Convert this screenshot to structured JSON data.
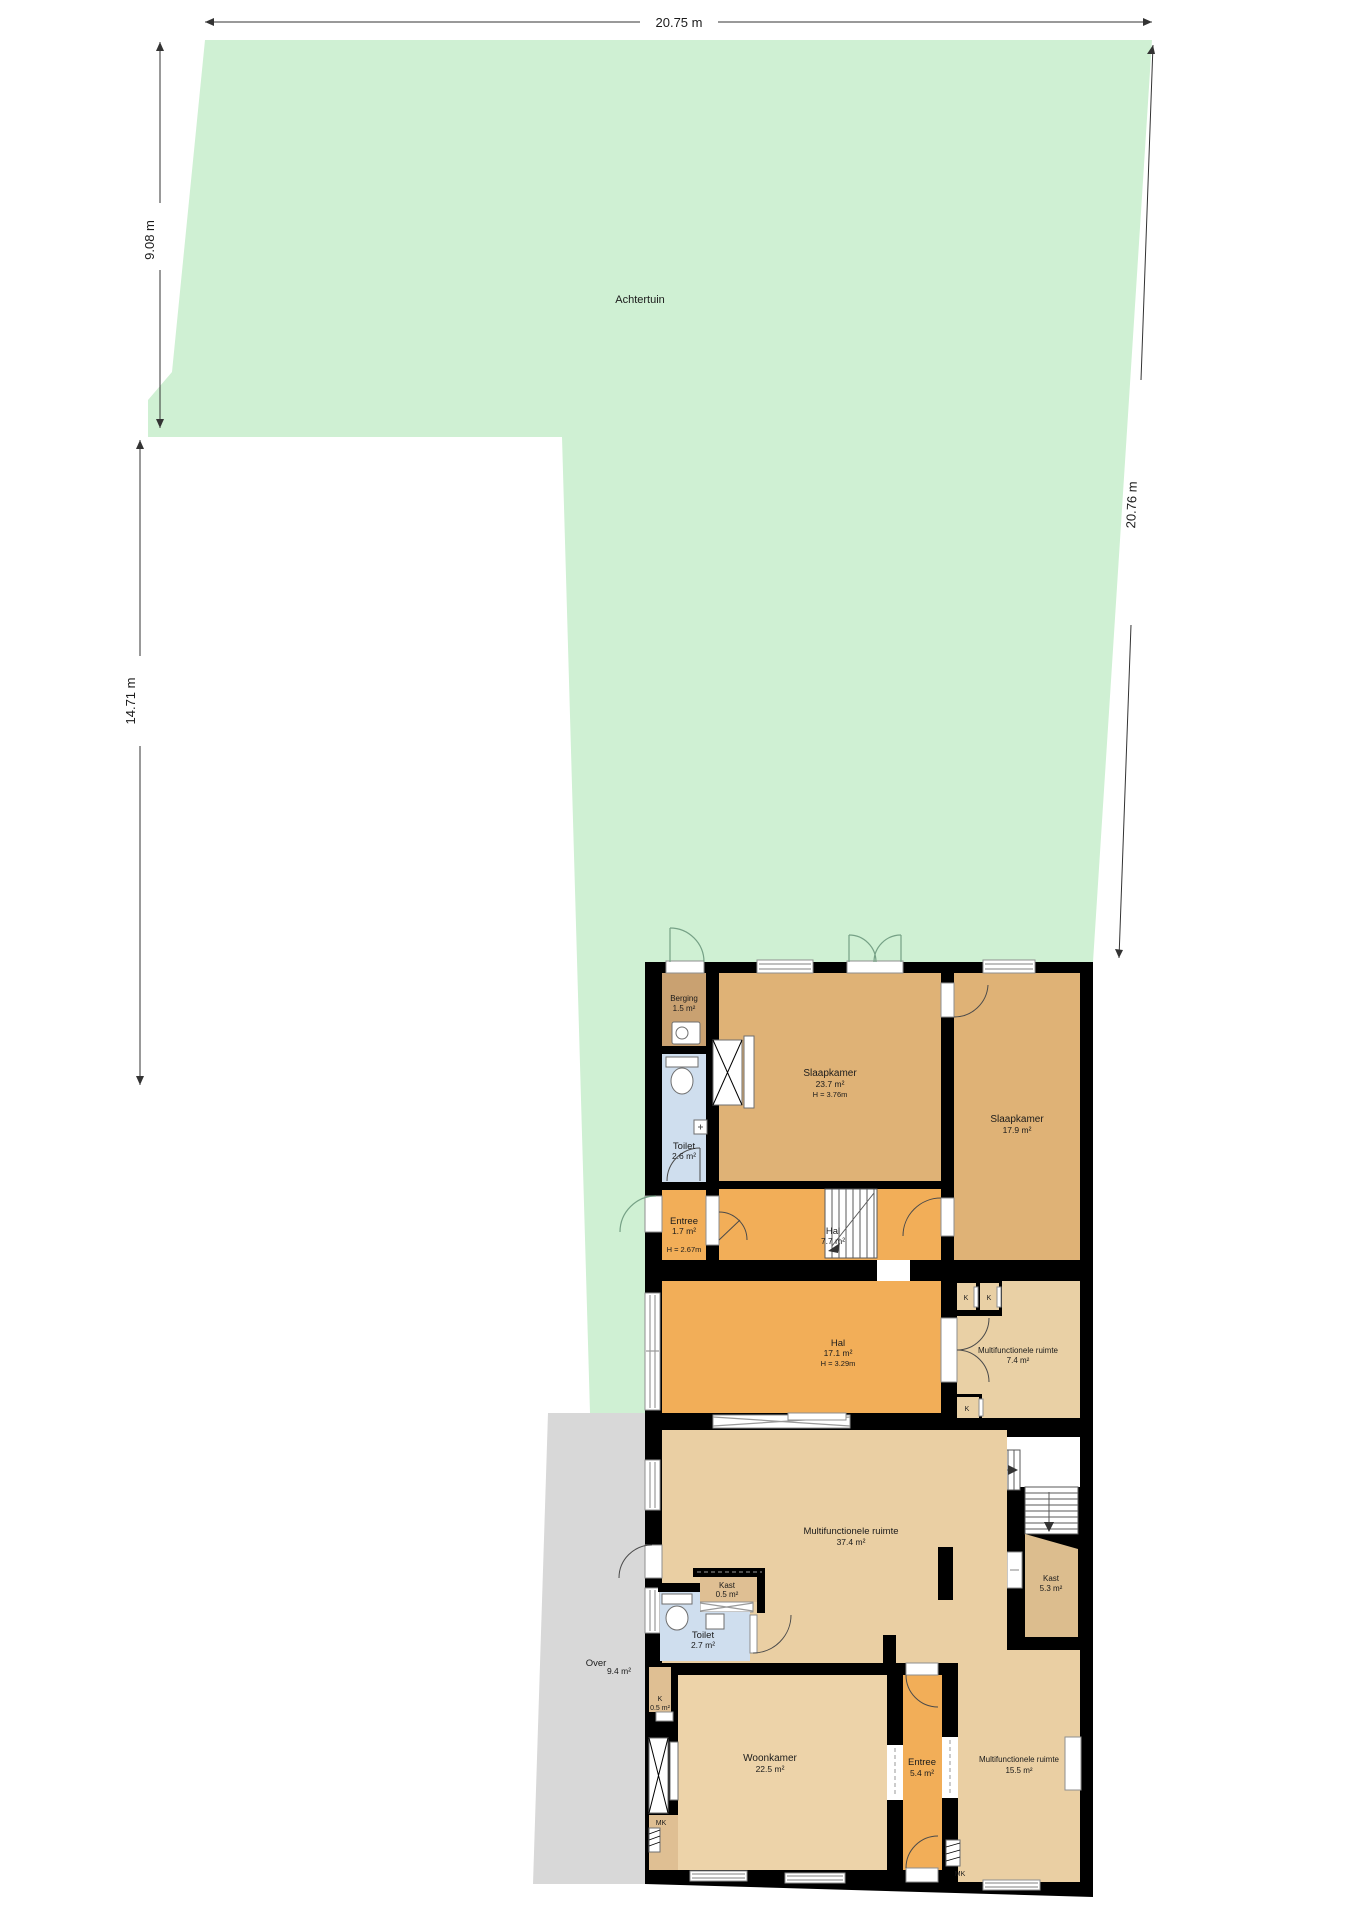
{
  "palette": {
    "garden_green": "#cff0d3",
    "paving_gray": "#d8d8d8",
    "bedroom_tan": "#dfb276",
    "storage_brown": "#c9a171",
    "hall_orange": "#f2ae58",
    "living_beige": "#eacfa3",
    "closet_tan": "#dfbf93",
    "kast_dark_tan": "#dcbd8e",
    "toilet_blue": "#cfdeee",
    "wall_black": "#000000"
  },
  "garden": {
    "label": "Achtertuin"
  },
  "over_area": {
    "label": "Over",
    "area": "9.4 m²"
  },
  "dimensions": {
    "top": "20.75 m",
    "left_upper": "9.08 m",
    "left_lower": "14.71 m",
    "right": "20.76 m"
  },
  "rooms": {
    "berging": {
      "name": "Berging",
      "area": "1.5 m²"
    },
    "toilet_boven": {
      "name": "Toilet",
      "area": "2.6 m²"
    },
    "slaapkamer_groot": {
      "name": "Slaapkamer",
      "area": "23.7 m²",
      "height": "H = 3.76m"
    },
    "slaapkamer_klein": {
      "name": "Slaapkamer",
      "area": "17.9 m²"
    },
    "entree_boven": {
      "name": "Entree",
      "area": "1.7 m²",
      "height": "H = 2.67m"
    },
    "hal_boven": {
      "name": "Hal",
      "area": "7.7 m²"
    },
    "hal_midden": {
      "name": "Hal",
      "area": "17.1 m²",
      "height": "H = 3.29m"
    },
    "multifunctioneel_klein": {
      "name": "Multifunctionele ruimte",
      "area": "7.4 m²"
    },
    "multifunctioneel_groot": {
      "name": "Multifunctionele ruimte",
      "area": "37.4 m²"
    },
    "kast_klein": {
      "name": "Kast",
      "area": "0.5 m²"
    },
    "kast_groot": {
      "name": "Kast",
      "area": "5.3 m²"
    },
    "toilet_beneden": {
      "name": "Toilet",
      "area": "2.7 m²"
    },
    "k_kast": {
      "name": "K",
      "area": "0.5 m²"
    },
    "woonkamer": {
      "name": "Woonkamer",
      "area": "22.5 m²"
    },
    "entree_beneden": {
      "name": "Entree",
      "area": "5.4 m²"
    },
    "multifunctioneel_voor": {
      "name": "Multifunctionele ruimte",
      "area": "15.5 m²"
    }
  },
  "labels": {
    "k": "K",
    "mk": "MK"
  }
}
